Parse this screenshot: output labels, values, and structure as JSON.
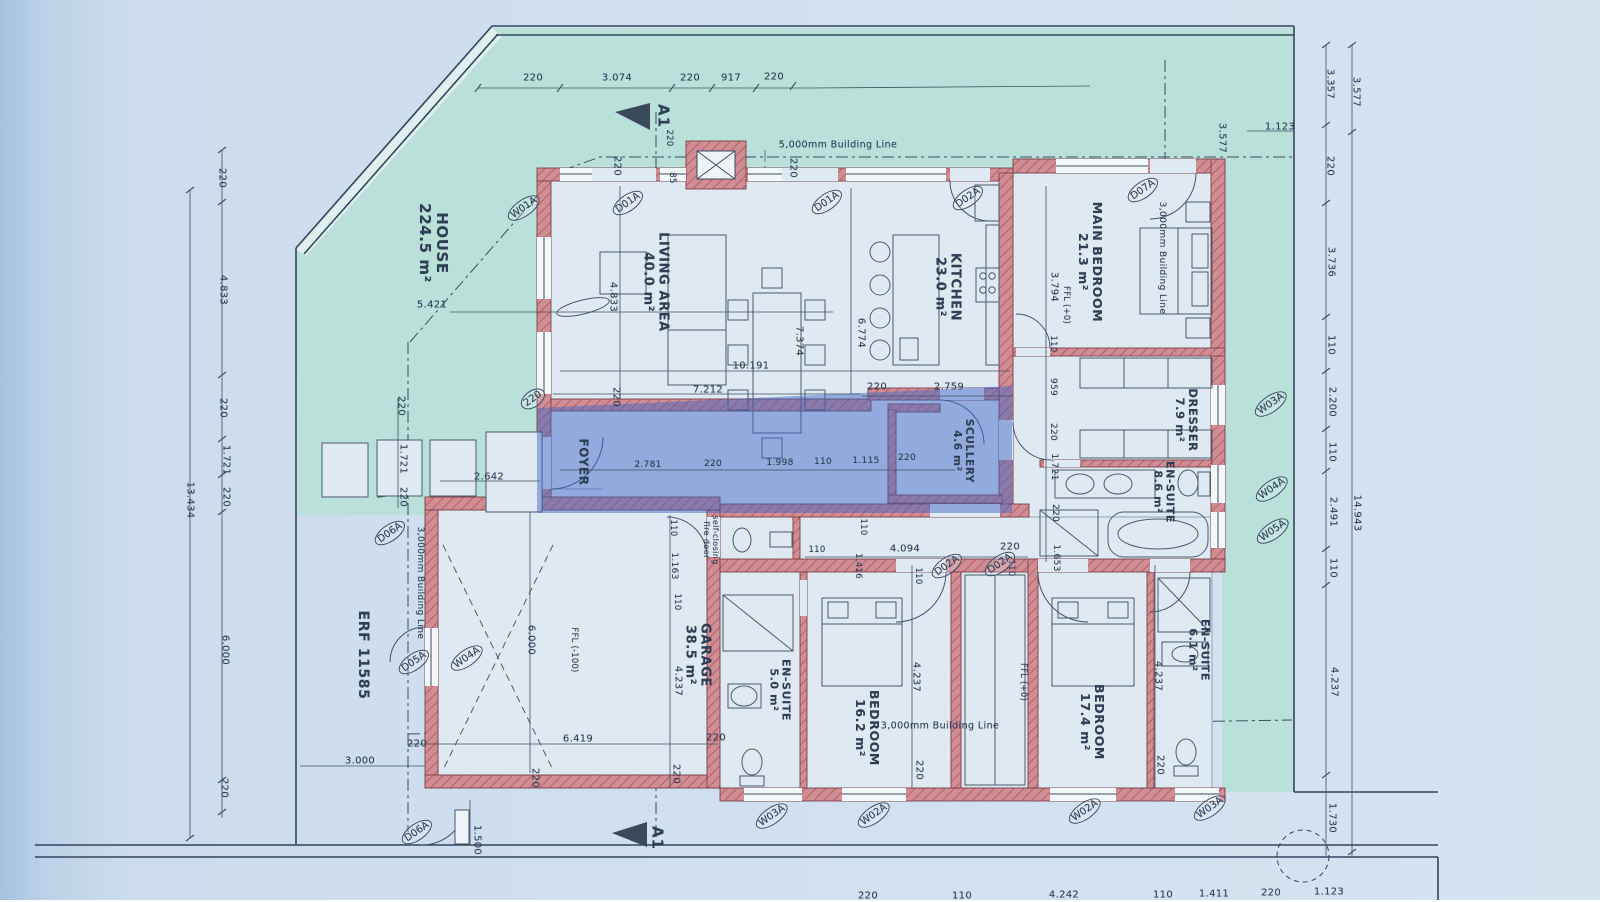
{
  "drawing": {
    "kind": "architectural floor plan (scanned)",
    "erf_label": "ERF 11585",
    "house_area_label": "HOUSE 224.5 m²"
  },
  "colors": {
    "page_blue": "#ccdcee",
    "site_teal": "#b9e1da",
    "wall_pink": "#d08d93",
    "wall_hatch": "#b4616b",
    "room_fill": "#dfe9f2",
    "line_ink": "#3c4c60",
    "highlight_blue": "rgba(62,103,198,0.48)"
  },
  "rooms": [
    {
      "name": "room-label-house",
      "text": "HOUSE\n224.5 m²",
      "x": 433,
      "y": 243,
      "rot": 90,
      "fs": 15
    },
    {
      "name": "room-label-living-area",
      "text": "LIVING AREA\n40.0 m²",
      "x": 655,
      "y": 282,
      "rot": 90,
      "fs": 13
    },
    {
      "name": "room-label-kitchen",
      "text": "KITCHEN\n23.0 m²",
      "x": 947,
      "y": 287,
      "rot": 90,
      "fs": 13
    },
    {
      "name": "room-label-main-bedroom",
      "text": "MAIN BEDROOM\n21.3 m²",
      "x": 1090,
      "y": 262,
      "rot": 90,
      "fs": 12.5
    },
    {
      "name": "room-label-dresser",
      "text": "DRESSER\n7.9 m²",
      "x": 1186,
      "y": 420,
      "rot": 90,
      "fs": 11.5
    },
    {
      "name": "room-label-ensuite-main",
      "text": "EN-SUITE\n8.6 m²",
      "x": 1163,
      "y": 492,
      "rot": 90,
      "fs": 11
    },
    {
      "name": "room-label-foyer",
      "text": "FOYER",
      "x": 583,
      "y": 462,
      "rot": 90,
      "fs": 12
    },
    {
      "name": "room-label-scullery",
      "text": "SCULLERY\n4.6 m²",
      "x": 962,
      "y": 451,
      "rot": 90,
      "fs": 10.5
    },
    {
      "name": "room-label-garage",
      "text": "GARAGE\n38.5 m²",
      "x": 697,
      "y": 655,
      "rot": 90,
      "fs": 13
    },
    {
      "name": "room-label-ensuite-5",
      "text": "EN-SUITE\n5.0 m²",
      "x": 779,
      "y": 690,
      "rot": 90,
      "fs": 11
    },
    {
      "name": "room-label-bedroom-162",
      "text": "BEDROOM\n16.2 m²",
      "x": 867,
      "y": 728,
      "rot": 90,
      "fs": 12.5
    },
    {
      "name": "room-label-bedroom-174",
      "text": "BEDROOM\n17.4 m²",
      "x": 1092,
      "y": 722,
      "rot": 90,
      "fs": 12.5
    },
    {
      "name": "room-label-ensuite-61",
      "text": "EN-SUITE\n6.1 m²",
      "x": 1198,
      "y": 650,
      "rot": 90,
      "fs": 11
    },
    {
      "name": "site-label-erf",
      "text": "ERF 11585",
      "x": 362,
      "y": 655,
      "rot": 90,
      "fs": 14
    }
  ],
  "levels": [
    {
      "name": "ffl-main-bedroom",
      "text": "FFL (+0)",
      "x": 1065,
      "y": 305,
      "rot": 90,
      "fs": 8.5
    },
    {
      "name": "ffl-garage",
      "text": "FFL (-100)",
      "x": 573,
      "y": 650,
      "rot": 90,
      "fs": 8.5
    },
    {
      "name": "ffl-bedroom-wing",
      "text": "FFL (+0)",
      "x": 1022,
      "y": 682,
      "rot": 90,
      "fs": 8.5
    }
  ],
  "annotations": [
    {
      "name": "building-line-top",
      "text": "5,000mm Building Line",
      "x": 838,
      "y": 146,
      "rot": 0,
      "fs": 9.5
    },
    {
      "name": "building-line-left",
      "text": "3,000mm Building Line",
      "x": 420,
      "y": 583,
      "rot": 90,
      "fs": 9
    },
    {
      "name": "building-line-right",
      "text": "3,000mm Building Line",
      "x": 1162,
      "y": 258,
      "rot": 90,
      "fs": 9
    },
    {
      "name": "building-line-bottom",
      "text": "3,000mm Building Line",
      "x": 940,
      "y": 727,
      "rot": 0,
      "fs": 9.5
    },
    {
      "name": "fire-door-note",
      "text": "self-closing\nfire door",
      "x": 710,
      "y": 540,
      "rot": 90,
      "fs": 8
    }
  ],
  "section_markers": [
    {
      "name": "section-marker-a1-top",
      "text": "A1",
      "x": 663,
      "y": 116,
      "rot": 90,
      "fs": 15
    },
    {
      "name": "section-marker-a1-bottom",
      "text": "A1",
      "x": 657,
      "y": 838,
      "rot": 90,
      "fs": 15
    }
  ],
  "dimensions": [
    {
      "name": "dim",
      "text": "220",
      "x": 533,
      "y": 78,
      "rot": 0
    },
    {
      "name": "dim",
      "text": "3.074",
      "x": 617,
      "y": 78,
      "rot": 0
    },
    {
      "name": "dim",
      "text": "220",
      "x": 690,
      "y": 78,
      "rot": 0
    },
    {
      "name": "dim",
      "text": "917",
      "x": 731,
      "y": 78,
      "rot": 0
    },
    {
      "name": "dim",
      "text": "220",
      "x": 774,
      "y": 77,
      "rot": 0
    },
    {
      "name": "dim",
      "text": "1.123",
      "x": 1280,
      "y": 127,
      "rot": 0
    },
    {
      "name": "dim",
      "text": "3.577",
      "x": 1222,
      "y": 138,
      "rot": 90
    },
    {
      "name": "dim",
      "text": "3.357",
      "x": 1330,
      "y": 84,
      "rot": 90
    },
    {
      "name": "dim",
      "text": "3.577",
      "x": 1356,
      "y": 92,
      "rot": 90
    },
    {
      "name": "dim",
      "text": "220",
      "x": 1330,
      "y": 166,
      "rot": 90
    },
    {
      "name": "dim",
      "text": "3.736",
      "x": 1331,
      "y": 262,
      "rot": 90
    },
    {
      "name": "dim",
      "text": "110",
      "x": 1331,
      "y": 345,
      "rot": 90
    },
    {
      "name": "dim",
      "text": "2.200",
      "x": 1332,
      "y": 402,
      "rot": 90
    },
    {
      "name": "dim",
      "text": "110",
      "x": 1332,
      "y": 452,
      "rot": 90
    },
    {
      "name": "dim",
      "text": "2.491",
      "x": 1333,
      "y": 512,
      "rot": 90
    },
    {
      "name": "dim",
      "text": "110",
      "x": 1333,
      "y": 568,
      "rot": 90
    },
    {
      "name": "dim",
      "text": "4.237",
      "x": 1334,
      "y": 682,
      "rot": 90
    },
    {
      "name": "dim",
      "text": "14.943",
      "x": 1357,
      "y": 513,
      "rot": 90
    },
    {
      "name": "dim",
      "text": "1.730",
      "x": 1332,
      "y": 818,
      "rot": 90
    },
    {
      "name": "dim",
      "text": "220",
      "x": 222,
      "y": 178,
      "rot": 90
    },
    {
      "name": "dim",
      "text": "4.833",
      "x": 223,
      "y": 290,
      "rot": 90
    },
    {
      "name": "dim",
      "text": "220",
      "x": 223,
      "y": 408,
      "rot": 90
    },
    {
      "name": "dim",
      "text": "1.721",
      "x": 226,
      "y": 460,
      "rot": 90
    },
    {
      "name": "dim",
      "text": "220",
      "x": 226,
      "y": 497,
      "rot": 90
    },
    {
      "name": "dim",
      "text": "6.000",
      "x": 225,
      "y": 650,
      "rot": 90
    },
    {
      "name": "dim",
      "text": "220",
      "x": 224,
      "y": 788,
      "rot": 90
    },
    {
      "name": "dim",
      "text": "13.434",
      "x": 190,
      "y": 500,
      "rot": 90
    },
    {
      "name": "dim",
      "text": "220",
      "x": 401,
      "y": 406,
      "rot": 90
    },
    {
      "name": "dim",
      "text": "1.721",
      "x": 403,
      "y": 459,
      "rot": 90
    },
    {
      "name": "dim",
      "text": "220",
      "x": 403,
      "y": 497,
      "rot": 90
    },
    {
      "name": "dim",
      "text": "2.642",
      "x": 489,
      "y": 477,
      "rot": 0
    },
    {
      "name": "dim",
      "text": "5.421",
      "x": 432,
      "y": 305,
      "rot": 0
    },
    {
      "name": "dim",
      "text": "220",
      "x": 617,
      "y": 166,
      "rot": 90
    },
    {
      "name": "dim",
      "text": "4.833",
      "x": 613,
      "y": 297,
      "rot": 90
    },
    {
      "name": "dim",
      "text": "220",
      "x": 616,
      "y": 397,
      "rot": 90
    },
    {
      "name": "dim",
      "text": "7.212",
      "x": 708,
      "y": 390,
      "rot": 0
    },
    {
      "name": "dim",
      "text": "10.191",
      "x": 751,
      "y": 366,
      "rot": 0
    },
    {
      "name": "dim",
      "text": "7.374",
      "x": 799,
      "y": 341,
      "rot": 90
    },
    {
      "name": "dim",
      "text": "220",
      "x": 793,
      "y": 168,
      "rot": 90
    },
    {
      "name": "dim",
      "text": "220",
      "x": 668,
      "y": 138,
      "rot": 90,
      "fs": 8.5
    },
    {
      "name": "dim",
      "text": "85",
      "x": 671,
      "y": 178,
      "rot": 90,
      "fs": 8.5
    },
    {
      "name": "dim",
      "text": "6.774",
      "x": 861,
      "y": 333,
      "rot": 90
    },
    {
      "name": "dim",
      "text": "3.794",
      "x": 1054,
      "y": 287,
      "rot": 90
    },
    {
      "name": "dim",
      "text": "220",
      "x": 877,
      "y": 387,
      "rot": 0
    },
    {
      "name": "dim",
      "text": "2.759",
      "x": 949,
      "y": 387,
      "rot": 0
    },
    {
      "name": "dim",
      "text": "110",
      "x": 1052,
      "y": 344,
      "rot": 90,
      "fs": 8.5
    },
    {
      "name": "dim",
      "text": "959",
      "x": 1053,
      "y": 387,
      "rot": 90,
      "fs": 9
    },
    {
      "name": "dim",
      "text": "220",
      "x": 1053,
      "y": 432,
      "rot": 90,
      "fs": 9
    },
    {
      "name": "dim",
      "text": "1.721",
      "x": 1054,
      "y": 467,
      "rot": 90,
      "fs": 9
    },
    {
      "name": "dim",
      "text": "220",
      "x": 1055,
      "y": 513,
      "rot": 90,
      "fs": 9
    },
    {
      "name": "dim",
      "text": "1.653",
      "x": 1056,
      "y": 558,
      "rot": 90,
      "fs": 9
    },
    {
      "name": "dim",
      "text": "2.781",
      "x": 648,
      "y": 465,
      "rot": 0,
      "fs": 9
    },
    {
      "name": "dim",
      "text": "220",
      "x": 713,
      "y": 464,
      "rot": 0,
      "fs": 9
    },
    {
      "name": "dim",
      "text": "1.998",
      "x": 780,
      "y": 463,
      "rot": 0,
      "fs": 9
    },
    {
      "name": "dim",
      "text": "110",
      "x": 823,
      "y": 462,
      "rot": 0,
      "fs": 9
    },
    {
      "name": "dim",
      "text": "1.115",
      "x": 866,
      "y": 461,
      "rot": 0,
      "fs": 9
    },
    {
      "name": "dim",
      "text": "220",
      "x": 907,
      "y": 458,
      "rot": 0,
      "fs": 9
    },
    {
      "name": "dim",
      "text": "6.000",
      "x": 531,
      "y": 640,
      "rot": 90
    },
    {
      "name": "dim",
      "text": "6.419",
      "x": 578,
      "y": 739,
      "rot": 0
    },
    {
      "name": "dim",
      "text": "220",
      "x": 417,
      "y": 744,
      "rot": 0
    },
    {
      "name": "dim",
      "text": "220",
      "x": 535,
      "y": 778,
      "rot": 90
    },
    {
      "name": "dim",
      "text": "220",
      "x": 676,
      "y": 774,
      "rot": 90
    },
    {
      "name": "dim",
      "text": "220",
      "x": 716,
      "y": 738,
      "rot": 0
    },
    {
      "name": "dim",
      "text": "3.000",
      "x": 360,
      "y": 761,
      "rot": 0
    },
    {
      "name": "dim",
      "text": "1.500",
      "x": 477,
      "y": 840,
      "rot": 90
    },
    {
      "name": "dim",
      "text": "110",
      "x": 672,
      "y": 528,
      "rot": 90,
      "fs": 8.5
    },
    {
      "name": "dim",
      "text": "1.163",
      "x": 674,
      "y": 566,
      "rot": 90,
      "fs": 9
    },
    {
      "name": "dim",
      "text": "110",
      "x": 676,
      "y": 602,
      "rot": 90,
      "fs": 8.5
    },
    {
      "name": "dim",
      "text": "4.237",
      "x": 678,
      "y": 681,
      "rot": 90
    },
    {
      "name": "dim",
      "text": "110",
      "x": 817,
      "y": 551,
      "rot": 0,
      "fs": 8.5
    },
    {
      "name": "dim",
      "text": "4.094",
      "x": 905,
      "y": 549,
      "rot": 0
    },
    {
      "name": "dim",
      "text": "220",
      "x": 1010,
      "y": 547,
      "rot": 0
    },
    {
      "name": "dim",
      "text": "110",
      "x": 862,
      "y": 527,
      "rot": 90,
      "fs": 8.5
    },
    {
      "name": "dim",
      "text": "1.416",
      "x": 857,
      "y": 566,
      "rot": 90,
      "fs": 8.5
    },
    {
      "name": "dim",
      "text": "110",
      "x": 917,
      "y": 576,
      "rot": 90,
      "fs": 8.5
    },
    {
      "name": "dim",
      "text": "110",
      "x": 1010,
      "y": 568,
      "rot": 90,
      "fs": 8.5
    },
    {
      "name": "dim",
      "text": "4.237",
      "x": 916,
      "y": 677,
      "rot": 90
    },
    {
      "name": "dim",
      "text": "220",
      "x": 919,
      "y": 770,
      "rot": 90
    },
    {
      "name": "dim",
      "text": "4.237",
      "x": 1158,
      "y": 676,
      "rot": 90
    },
    {
      "name": "dim",
      "text": "220",
      "x": 1160,
      "y": 765,
      "rot": 90
    },
    {
      "name": "dim",
      "text": "220",
      "x": 868,
      "y": 896,
      "rot": 0
    },
    {
      "name": "dim",
      "text": "110",
      "x": 962,
      "y": 896,
      "rot": 0
    },
    {
      "name": "dim",
      "text": "4.242",
      "x": 1064,
      "y": 895,
      "rot": 0
    },
    {
      "name": "dim",
      "text": "110",
      "x": 1163,
      "y": 895,
      "rot": 0
    },
    {
      "name": "dim",
      "text": "1.411",
      "x": 1214,
      "y": 894,
      "rot": 0
    },
    {
      "name": "dim",
      "text": "220",
      "x": 1271,
      "y": 893,
      "rot": 0
    },
    {
      "name": "dim",
      "text": "1.123",
      "x": 1329,
      "y": 892,
      "rot": 0
    }
  ],
  "tags": [
    {
      "name": "window-tag",
      "text": "W01A",
      "x": 524,
      "y": 208,
      "rot": -35
    },
    {
      "name": "door-tag",
      "text": "D01A",
      "x": 628,
      "y": 203,
      "rot": -35
    },
    {
      "name": "door-tag",
      "text": "D01A",
      "x": 827,
      "y": 202,
      "rot": -35
    },
    {
      "name": "door-tag",
      "text": "D02A",
      "x": 968,
      "y": 198,
      "rot": -35
    },
    {
      "name": "door-tag",
      "text": "D07A",
      "x": 1143,
      "y": 190,
      "rot": -35
    },
    {
      "name": "window-tag",
      "text": "W03A",
      "x": 1271,
      "y": 404,
      "rot": -35
    },
    {
      "name": "window-tag",
      "text": "W04A",
      "x": 1272,
      "y": 489,
      "rot": -35
    },
    {
      "name": "window-tag",
      "text": "W05A",
      "x": 1273,
      "y": 531,
      "rot": -35
    },
    {
      "name": "door-tag",
      "text": "D02A",
      "x": 947,
      "y": 566,
      "rot": -35
    },
    {
      "name": "door-tag",
      "text": "D02A",
      "x": 1000,
      "y": 564,
      "rot": -35
    },
    {
      "name": "door-tag",
      "text": "D06A",
      "x": 390,
      "y": 533,
      "rot": -35
    },
    {
      "name": "door-tag",
      "text": "D05A",
      "x": 414,
      "y": 662,
      "rot": -35
    },
    {
      "name": "window-tag",
      "text": "W04A",
      "x": 467,
      "y": 658,
      "rot": -35
    },
    {
      "name": "door-tag",
      "text": "D06A",
      "x": 417,
      "y": 832,
      "rot": -35
    },
    {
      "name": "window-tag",
      "text": "W03A",
      "x": 772,
      "y": 816,
      "rot": -35
    },
    {
      "name": "window-tag",
      "text": "W02A",
      "x": 874,
      "y": 815,
      "rot": -35
    },
    {
      "name": "window-tag",
      "text": "W02A",
      "x": 1085,
      "y": 811,
      "rot": -35
    },
    {
      "name": "window-tag",
      "text": "W03A",
      "x": 1210,
      "y": 808,
      "rot": -35
    },
    {
      "name": "dim-tag",
      "text": "220",
      "x": 533,
      "y": 399,
      "rot": -35
    }
  ]
}
